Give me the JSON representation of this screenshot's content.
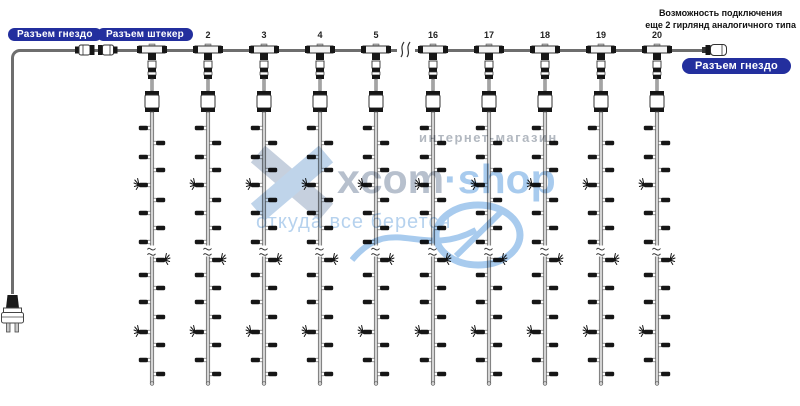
{
  "labels": {
    "left_socket": "Разъем гнездо",
    "left_plug": "Разъем штекер",
    "right_socket": "Разъем гнездо"
  },
  "note": {
    "line1": "Возможность подключения",
    "line2": "еще 2 гирлянд аналогичного типа"
  },
  "watermark": {
    "brand_gray": "xcom",
    "brand_blue": "·shop",
    "tagline_top": "интернет-магазин",
    "tagline_bottom": "откуда все берется"
  },
  "drops": [
    {
      "number": "",
      "x": 152
    },
    {
      "number": "2",
      "x": 208
    },
    {
      "number": "3",
      "x": 264
    },
    {
      "number": "4",
      "x": 320
    },
    {
      "number": "5",
      "x": 376
    },
    {
      "number": "16",
      "x": 433
    },
    {
      "number": "17",
      "x": 489
    },
    {
      "number": "18",
      "x": 545
    },
    {
      "number": "19",
      "x": 601
    },
    {
      "number": "20",
      "x": 657
    }
  ],
  "string_pattern": [
    {
      "y": 128,
      "t": "bulb",
      "side": "left"
    },
    {
      "y": 143,
      "t": "bulb",
      "side": "right"
    },
    {
      "y": 157,
      "t": "bulb",
      "side": "left"
    },
    {
      "y": 170,
      "t": "bulb",
      "side": "right"
    },
    {
      "y": 185,
      "t": "flash",
      "side": "left"
    },
    {
      "y": 200,
      "t": "bulb",
      "side": "right"
    },
    {
      "y": 213,
      "t": "bulb",
      "side": "left"
    },
    {
      "y": 228,
      "t": "bulb",
      "side": "right"
    },
    {
      "y": 242,
      "t": "bulb",
      "side": "left"
    },
    {
      "y": 251,
      "t": "break",
      "side": "center"
    },
    {
      "y": 260,
      "t": "flash",
      "side": "right"
    },
    {
      "y": 275,
      "t": "bulb",
      "side": "left"
    },
    {
      "y": 288,
      "t": "bulb",
      "side": "right"
    },
    {
      "y": 302,
      "t": "bulb",
      "side": "left"
    },
    {
      "y": 317,
      "t": "bulb",
      "side": "right"
    },
    {
      "y": 332,
      "t": "flash",
      "side": "left"
    },
    {
      "y": 345,
      "t": "bulb",
      "side": "right"
    },
    {
      "y": 360,
      "t": "bulb",
      "side": "left"
    },
    {
      "y": 374,
      "t": "bulb",
      "side": "right"
    }
  ],
  "main_wire_break_x": 396,
  "colors": {
    "pill_blue": "#232f9e",
    "wire_gray": "#6e6e6e",
    "bulb_black": "#161616",
    "watermark_gray": "#b7c0cd",
    "watermark_blue": "#a8cbee"
  }
}
